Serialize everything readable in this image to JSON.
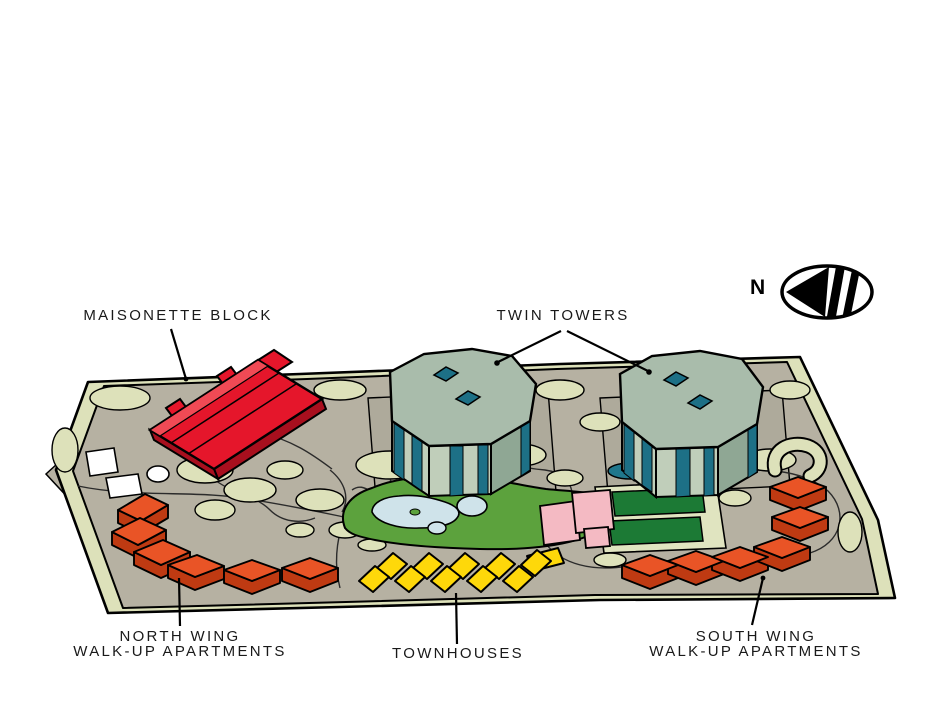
{
  "figure": {
    "kind": "illustrated housing estate site plan",
    "labels": {
      "maisonette": "MAISONETTE BLOCK",
      "twin_towers": "TWIN TOWERS",
      "north_wing": {
        "line1": "NORTH WING",
        "line2": "WALK-UP APARTMENTS"
      },
      "townhouses": "TOWNHOUSES",
      "south_wing": {
        "line1": "SOUTH WING",
        "line2": "WALK-UP APARTMENTS"
      },
      "compass_letter": "N"
    },
    "buildings": [
      {
        "name": "Maisonette Block",
        "appearance": "long red slab block, north-west of site"
      },
      {
        "name": "Twin Towers",
        "appearance": "two grey-green towers with teal cores and roof diamonds"
      },
      {
        "name": "North Wing Walk-Up Apartments",
        "appearance": "arc of orange blocks, south-west"
      },
      {
        "name": "Townhouses",
        "appearance": "zig-zag row of yellow units, south centre"
      },
      {
        "name": "South Wing Walk-Up Apartments",
        "appearance": "arc of orange blocks, south-east"
      }
    ],
    "site_features": [
      "scalloped shrub border around site",
      "central green with ponds",
      "pink community buildings",
      "two dark-green courts",
      "winding footpaths",
      "compass ellipse with arrow pointing left (north)"
    ],
    "colors": {
      "background": "#ffffff",
      "ink": "#000000",
      "ground": "#b6b1a2",
      "pad": "#aeaa9b",
      "shrub": "#dde1ba",
      "park_green": "#5ca23d",
      "pond_blue": "#cfe3ea",
      "pond_teal": "#20778c",
      "court_green": "#1c7a35",
      "court_pad": "#e0e4c0",
      "pink_building": "#f4bac3",
      "red_building": "#e5162b",
      "red_building_light": "#f04a55",
      "red_building_shade": "#a80f1e",
      "orange_building": "#e95426",
      "orange_building_shade": "#bf3a12",
      "yellow_building": "#fed80a",
      "tower_roof": "#a9bcab",
      "tower_wall": "#c0ceba",
      "tower_wall_shade": "#8fa794",
      "tower_teal": "#1d7086",
      "white_building": "#ffffff",
      "label_text": "#191919"
    }
  }
}
